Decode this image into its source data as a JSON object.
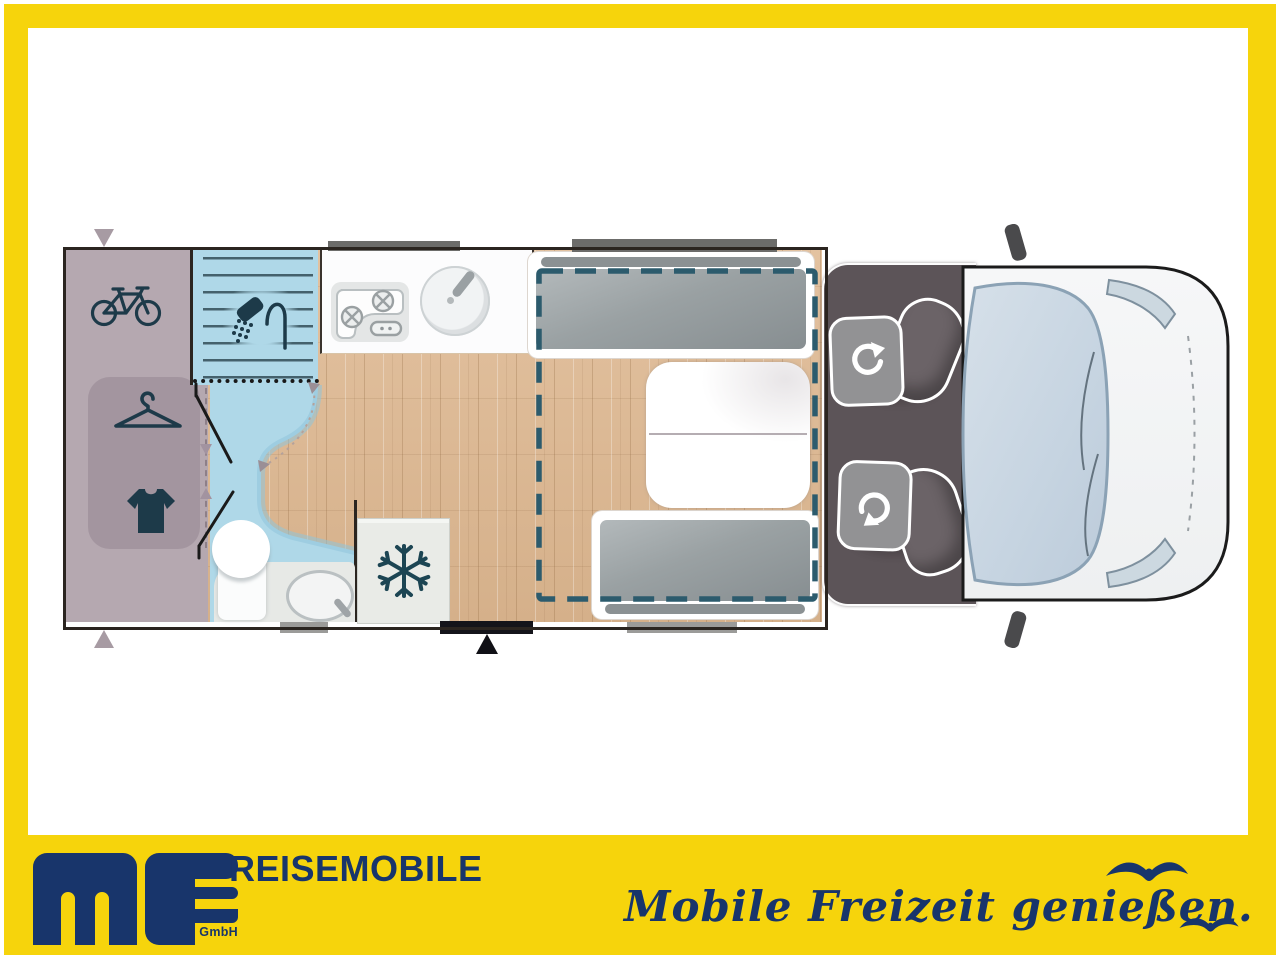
{
  "brand": {
    "logo_text": "ms",
    "logo_sub": "GmbH",
    "wordmark": "REISEMOBILE",
    "slogan": "Mobile Freizeit genießen."
  },
  "colors": {
    "frame_yellow": "#F6D40C",
    "brand_navy": "#18356B",
    "garage_mauve": "#B5A8B0",
    "bathroom_blue": "#AFD8E8",
    "wood_floor": "#DCBA96",
    "cab_gray": "#5C5458",
    "bed_outline_teal": "#2C5B6D",
    "icon_navy": "#1D3A49",
    "van_body": "#F5F6F7",
    "windshield_blue": "#CBD8E3"
  },
  "floorplan": {
    "view": "motorhome top view floor plan",
    "areas": [
      {
        "name": "rear-garage",
        "icons": [
          "bicycle-icon"
        ]
      },
      {
        "name": "wardrobe",
        "icons": [
          "hanger-icon",
          "shirt-icon"
        ]
      },
      {
        "name": "shower",
        "icons": [
          "shower-icon"
        ]
      },
      {
        "name": "bathroom",
        "icons": [
          "toilet",
          "washbasin"
        ]
      },
      {
        "name": "kitchen",
        "icons": [
          "stove-icon",
          "sink"
        ]
      },
      {
        "name": "refrigerator",
        "icons": [
          "snowflake-icon"
        ]
      },
      {
        "name": "dinette",
        "icons": [
          "table",
          "bench-seat",
          "bench-seat"
        ]
      },
      {
        "name": "drop-down-bed",
        "icons": [
          "dashed-outline"
        ]
      },
      {
        "name": "cab",
        "icons": [
          "swivel-seat-icon",
          "swivel-seat-icon"
        ]
      },
      {
        "name": "entry-door",
        "icons": [
          "door-arrow"
        ]
      }
    ]
  }
}
